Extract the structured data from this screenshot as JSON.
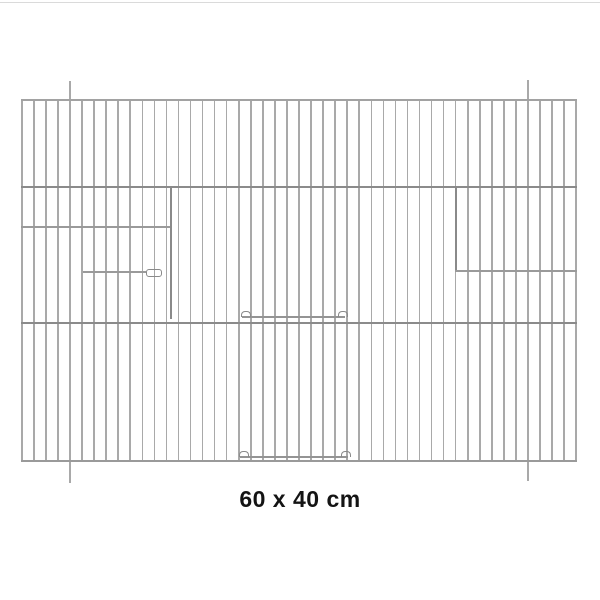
{
  "image": {
    "background": "#ffffff",
    "top_hairline_color": "#dadada"
  },
  "caption": {
    "text": "60 x 40 cm",
    "color": "#141414"
  },
  "panel": {
    "description_name": "wire-cage-front-panel",
    "left": 21,
    "top": 99,
    "width": 556,
    "height": 363,
    "bars": {
      "count": 47,
      "width": 1.6,
      "color": "#a9a9a9"
    },
    "long_bars": [
      {
        "index": 4,
        "above": 18,
        "below": 21
      },
      {
        "index": 42,
        "above": 19,
        "below": 19
      }
    ],
    "h_wires": [
      {
        "name": "top-edge-wire",
        "y": 0,
        "thickness": 1.6,
        "color": "#a2a2a2"
      },
      {
        "name": "upper-mid-wire",
        "y": 87,
        "thickness": 2,
        "color": "#8b8b8b"
      },
      {
        "name": "lower-mid-wire",
        "y": 223,
        "thickness": 2,
        "color": "#8b8b8b"
      },
      {
        "name": "bottom-edge-wire",
        "y": 361,
        "thickness": 2,
        "color": "#9a9a9a"
      }
    ],
    "dark_bars": [
      {
        "name": "left-door-frame-wire",
        "x": 149,
        "y1": 87,
        "y2": 220,
        "width": 2,
        "color": "#8a8a8a"
      },
      {
        "name": "right-door-frame-wire",
        "x": 434,
        "y1": 87,
        "y2": 172,
        "width": 2,
        "color": "#8a8a8a"
      }
    ],
    "rails": [
      {
        "name": "left-door-top-rail",
        "x1": 0,
        "x2": 149,
        "y": 127,
        "thickness": 1.6,
        "color": "#9a9a9a",
        "hooks": "none"
      },
      {
        "name": "left-door-latch-rail",
        "x1": 62,
        "x2": 125,
        "y": 172,
        "thickness": 1.5,
        "color": "#9a9a9a",
        "hooks": "loop-right"
      },
      {
        "name": "right-door-rail",
        "x1": 434,
        "x2": 556,
        "y": 171,
        "thickness": 1.6,
        "color": "#9a9a9a",
        "hooks": "none"
      },
      {
        "name": "center-door-top-rail",
        "x1": 221,
        "x2": 324,
        "y": 217,
        "thickness": 1.5,
        "color": "#949494",
        "hooks": "arch-both"
      },
      {
        "name": "center-door-bottom-rail",
        "x1": 219,
        "x2": 327,
        "y": 357,
        "thickness": 1.5,
        "color": "#949494",
        "hooks": "arch-both"
      }
    ]
  }
}
